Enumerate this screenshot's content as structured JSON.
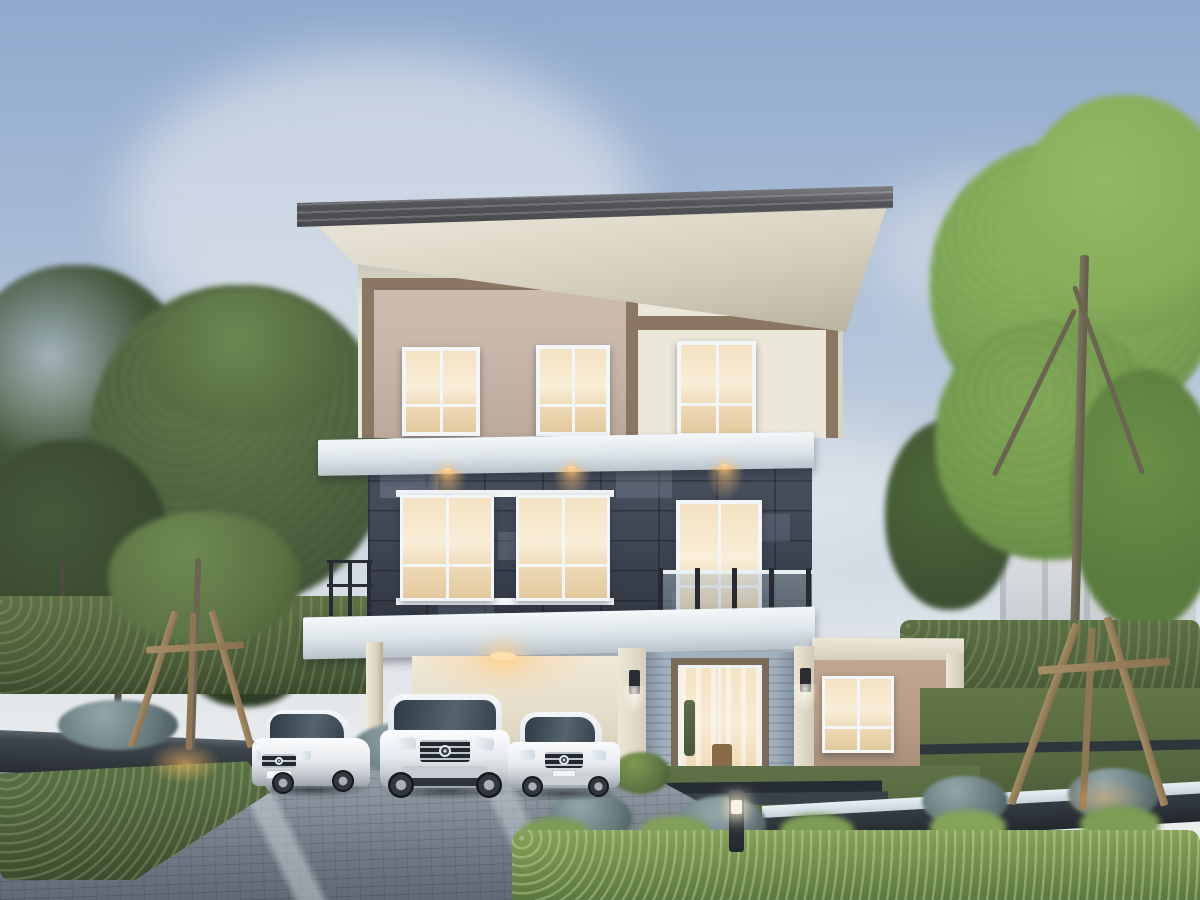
{
  "meta": {
    "title": "Dusk rendering of a modern three-storey house with carport, three white cars and landscaped garden",
    "width_px": 1200,
    "height_px": 900
  },
  "palette": {
    "sky-top": "#8fa9cd",
    "sky-mid": "#c6d2e0",
    "sky-horizon": "#eceeee",
    "roof-dark": "#55565a",
    "soffit": "#e6e1d2",
    "wall-taupe": "#c9b7ab",
    "wall-cream": "#ebe7d9",
    "frame-brown": "#8b7663",
    "slab-shade": "#b9c3cb",
    "stone-base": "#404754",
    "stone-dark": "#2f353f",
    "window-frame": "#f2f6f8",
    "glass-warm": "#f6e6c9",
    "siding-blue": "#a2b1bf",
    "door-brown": "#7b6a57",
    "annex-tan": "#b89e87",
    "green-dark": "#425436",
    "green-mid": "#5c7044",
    "green-bright": "#7b9b51",
    "lawn": "#5f7247",
    "drive-mid": "#8a939d",
    "car-white": "#edeff1",
    "wood": "#a68d66",
    "charcoal": "#343b42",
    "cap-white": "#e8f0f4",
    "glow-warm": "#ffc27a"
  },
  "scene": {
    "time_of_day": "dusk, warm interior and accent lights on",
    "sky": {
      "clouds": "soft wispy clouds upper left and right"
    },
    "house": {
      "storeys": 3,
      "roof": "flat cantilevered roof with dark grey fascia and cream soffit",
      "third_floor": "taupe panel in brown frame (left) and cream panel with brown trim (right), three lit windows",
      "second_floor": "dark slate stone cladding, wide double window, glass-railing balcony with sliding door, recessed downlights",
      "ground_floor": "open carport, blue-grey horizontal siding entrance with large glass door, two wall sconces",
      "annex": "single-storey tan wing on the right with one lit window"
    },
    "vehicles": [
      {
        "type": "coupe",
        "color": "white",
        "position": "left, outside carport",
        "license_plate": "illegible"
      },
      {
        "type": "suv",
        "color": "white",
        "position": "center, under carport"
      },
      {
        "type": "sedan",
        "color": "silver-white",
        "position": "right of carport"
      }
    ],
    "garden": {
      "left": [
        "tall dark-green trees",
        "clipped hedge",
        "charcoal raised planter",
        "young tree with wooden tripod support",
        "warm ground spotlight"
      ],
      "right": [
        "large bright-green tree",
        "hedge wall",
        "young tree with wooden tripod support",
        "low white-capped garden wall",
        "white building glimpsed behind trees"
      ],
      "foreground": [
        "grey paver driveway with light diagonal bands",
        "lawn with stepping pads",
        "bright green hedge",
        "blue-green shrubs",
        "dark bollard light glowing"
      ]
    }
  }
}
